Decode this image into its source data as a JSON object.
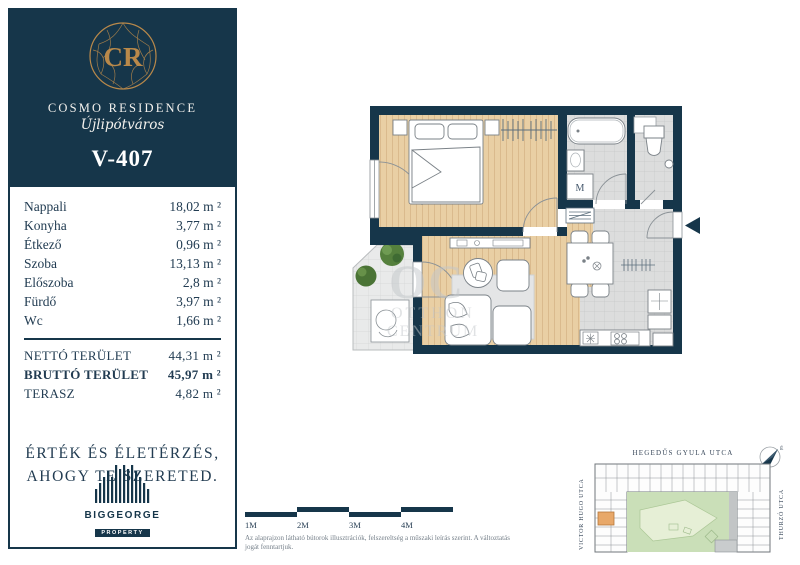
{
  "brand": {
    "monogram": "CR",
    "name": "COSMO RESIDENCE",
    "district": "Újlipótváros"
  },
  "unit": {
    "id": "V-407"
  },
  "rooms": {
    "items": [
      {
        "label": "Nappali",
        "value": "18,02 m ²"
      },
      {
        "label": "Konyha",
        "value": "3,77 m ²"
      },
      {
        "label": "Étkező",
        "value": "0,96 m ²"
      },
      {
        "label": "Szoba",
        "value": "13,13 m ²"
      },
      {
        "label": "Előszoba",
        "value": "2,8 m ²"
      },
      {
        "label": "Fürdő",
        "value": "3,97 m ²"
      },
      {
        "label": "Wc",
        "value": "1,66 m ²"
      }
    ],
    "totals": [
      {
        "label": "NETTÓ TERÜLET",
        "value": "44,31 m ²"
      },
      {
        "label": "BRUTTÓ TERÜLET",
        "value": "45,97 m ²"
      },
      {
        "label": "TERASZ",
        "value": "4,82 m ²"
      }
    ]
  },
  "tagline": {
    "line1": "ÉRTÉK ÉS ÉLETÉRZÉS,",
    "line2": "AHOGY TE SZERETED."
  },
  "developer": {
    "name": "BIGGEORGE",
    "sub": "PROPERTY"
  },
  "floorplan": {
    "washing_machine_label": "M",
    "watermark": {
      "initials": "OC",
      "line1": "OTTHON",
      "line2": "CENTRUM"
    }
  },
  "scalebar": {
    "labels": [
      "1M",
      "2M",
      "3M",
      "4M"
    ]
  },
  "disclaimer": {
    "text": "Az alaprajzon látható bútorok illusztrációk, felszereltség a műszaki leírás szerint. A változtatás jogát fenntartjuk."
  },
  "map": {
    "streets": {
      "top": "HEGEDŰS GYULA UTCA",
      "left": "VICTOR HUGO UTCA",
      "right": "THURZÓ UTCA"
    },
    "compass_label": "É"
  },
  "colors": {
    "navy": "#16364a",
    "gold": "#b9894a",
    "wood": "#e9cfa4",
    "tile": "#dcdddd",
    "terrace_tile": "#e9eaea",
    "courtyard_green": "#cadfb8",
    "highlight_orange": "#e8a869"
  }
}
